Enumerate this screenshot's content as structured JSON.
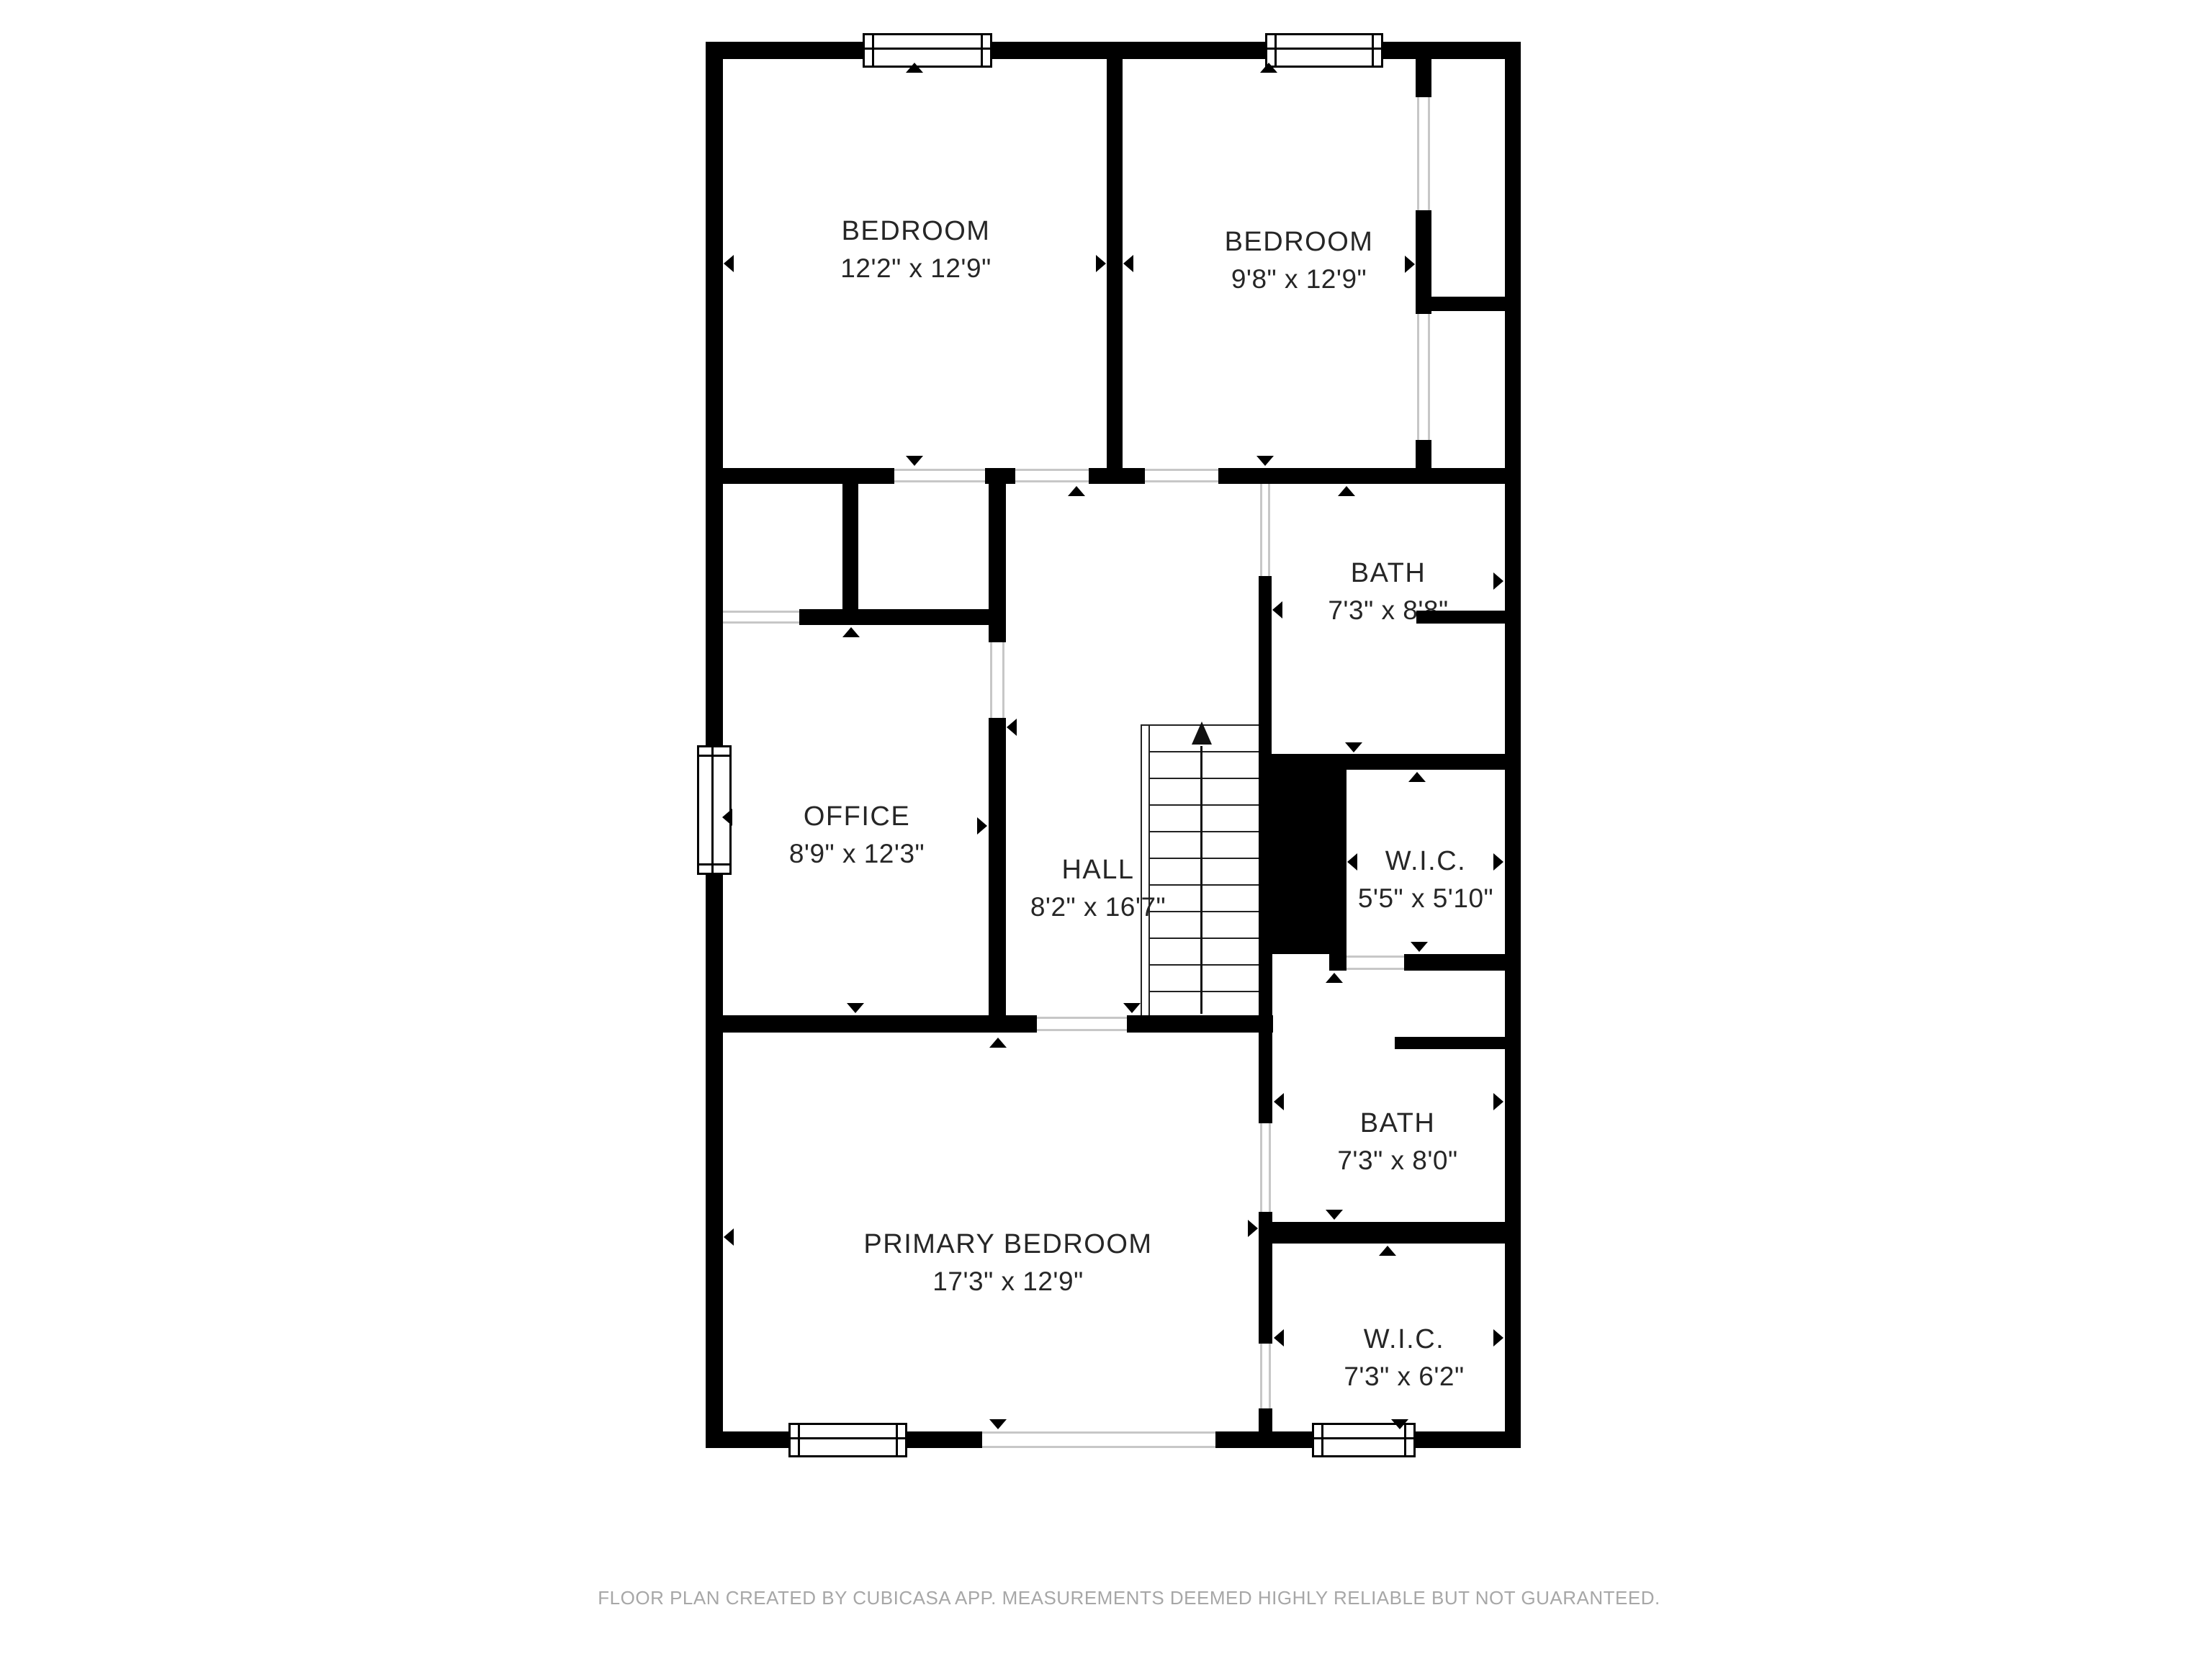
{
  "rooms": [
    {
      "name": "BEDROOM",
      "dims": "12'2\" x 12'9\""
    },
    {
      "name": "BEDROOM",
      "dims": "9'8\" x 12'9\""
    },
    {
      "name": "BATH",
      "dims": "7'3\" x 8'8\""
    },
    {
      "name": "OFFICE",
      "dims": "8'9\" x 12'3\""
    },
    {
      "name": "HALL",
      "dims": "8'2\" x 16'7\""
    },
    {
      "name": "W.I.C.",
      "dims": "5'5\" x 5'10\""
    },
    {
      "name": "BATH",
      "dims": "7'3\" x 8'0\""
    },
    {
      "name": "PRIMARY BEDROOM",
      "dims": "17'3\" x 12'9\""
    },
    {
      "name": "W.I.C.",
      "dims": "7'3\" x 6'2\""
    }
  ],
  "footer": "FLOOR PLAN CREATED BY CUBICASA APP. MEASUREMENTS DEEMED HIGHLY RELIABLE BUT NOT GUARANTEED.",
  "colors": {
    "wall": "#000000",
    "background": "#ffffff",
    "label": "#262626",
    "footer": "#a7a7a7",
    "opening_line": "#c7c7c7"
  }
}
